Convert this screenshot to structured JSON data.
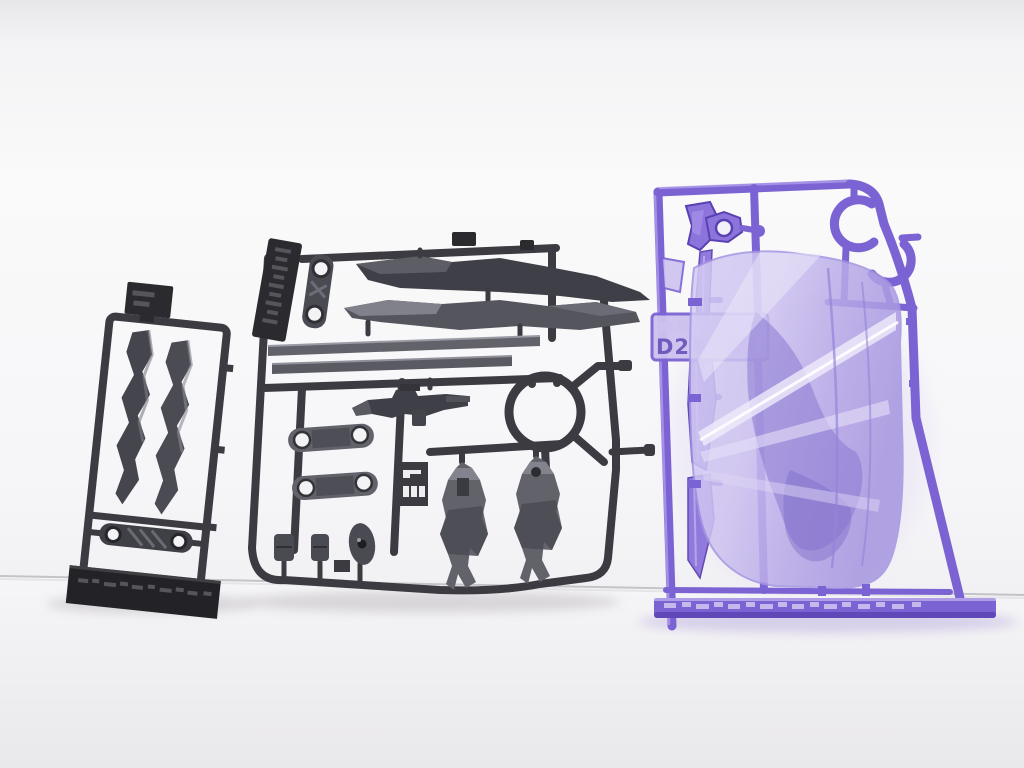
{
  "scene": {
    "description": "Photograph of three plastic model-kit part runners (sprues) standing against a white seamless backdrop",
    "sprues": {
      "left": {
        "plastic": "dark gray",
        "parts": [
          "two serrated blade parts",
          "linkage part with two round holes",
          "small gate plate",
          "molded runner tag bar with embossed text"
        ]
      },
      "center": {
        "plastic": "dark gray",
        "parts": [
          "two long blade parts",
          "hinge link with holes",
          "two flat strip parts",
          "rifle weapon part",
          "circular runner ring",
          "two arm frames with holes",
          "slotted part-number plate",
          "two leg armor parts",
          "small joint parts",
          "vertical tag with embossed Japanese text"
        ]
      },
      "right": {
        "plastic": "clear purple",
        "gate_label": "D2",
        "parts": [
          "large clear effect sheet",
          "two C-shaped hook parts",
          "hexagonal part with hole",
          "bracket part",
          "three thin fin parts",
          "embossed tag plate",
          "molded bottom bar with embossed text"
        ]
      }
    }
  },
  "labels": {
    "purple_gate": "D2"
  },
  "colors": {
    "wall_top": "#e7e7e9",
    "wall": "#fafafa",
    "wall_low": "#f1f0f3",
    "surface": "#f6f5f7",
    "surface_low": "#e9e8ea",
    "seam": "#bcbbbf",
    "shadow": "#d5d3d7",
    "purple_shadow": "#d6cfe9",
    "dark_frame": "#3b3b41",
    "dark_frame_deep": "#2a2a2f",
    "tag_dark": "#232327",
    "dark_part": "#62626b",
    "dark_part_deep": "#4a4a52",
    "dark_part_light": "#8f8f99",
    "blade_dark": "#45454d",
    "hole_light": "#f3f3f5",
    "purple_frame": "#7c63d4",
    "purple_deep": "#5a41b2",
    "purple_part": "#8d74dc",
    "purple_hl": "#c4b6f0",
    "sheet_a": "#d6cef4",
    "sheet_b": "#c2b5eb",
    "sheet_c": "#ab9ae2",
    "sheet_mid": "#8a78d2",
    "streak": "#f0ebfb",
    "emboss_dark": "#55555c",
    "emboss_purple": "#cdc1f0"
  }
}
